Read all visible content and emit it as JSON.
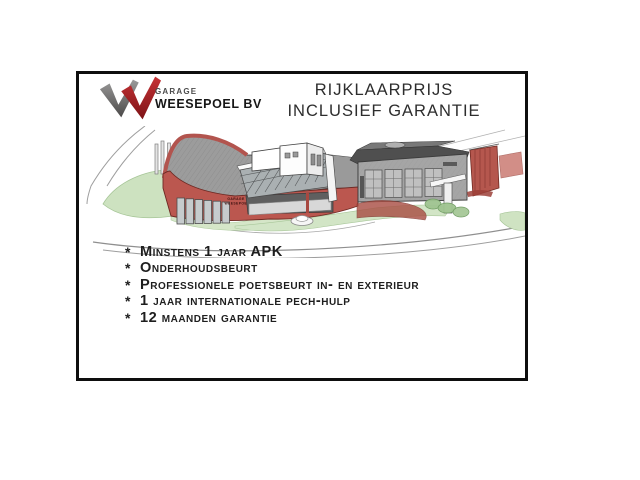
{
  "logo": {
    "company_prefix": "GARAGE",
    "company_name": "WEESEPOEL BV",
    "check_gray_top": "#9a9a9a",
    "check_gray_bottom": "#4c4a49",
    "check_red_top": "#c63336",
    "check_red_bottom": "#7d1216"
  },
  "title": {
    "line1": "RIJKLAARPRIJS",
    "line2": "INCLUSIEF GARANTIE"
  },
  "illustration": {
    "sign": {
      "line1": "GARAGE",
      "line2": "WEESEPOEL"
    },
    "colors": {
      "facade_red": "#bb574f",
      "roof_gray": "#9c9c9c",
      "grass_green": "#cde2c0",
      "sketch_line": "#9e9e9e"
    }
  },
  "features": {
    "bullet": "*",
    "items": [
      "Minstens 1 jaar APK",
      "Onderhoudsbeurt",
      "Professionele poetsbeurt in- en exterieur",
      "1 jaar internationale pech-hulp",
      "12 maanden garantie"
    ]
  }
}
